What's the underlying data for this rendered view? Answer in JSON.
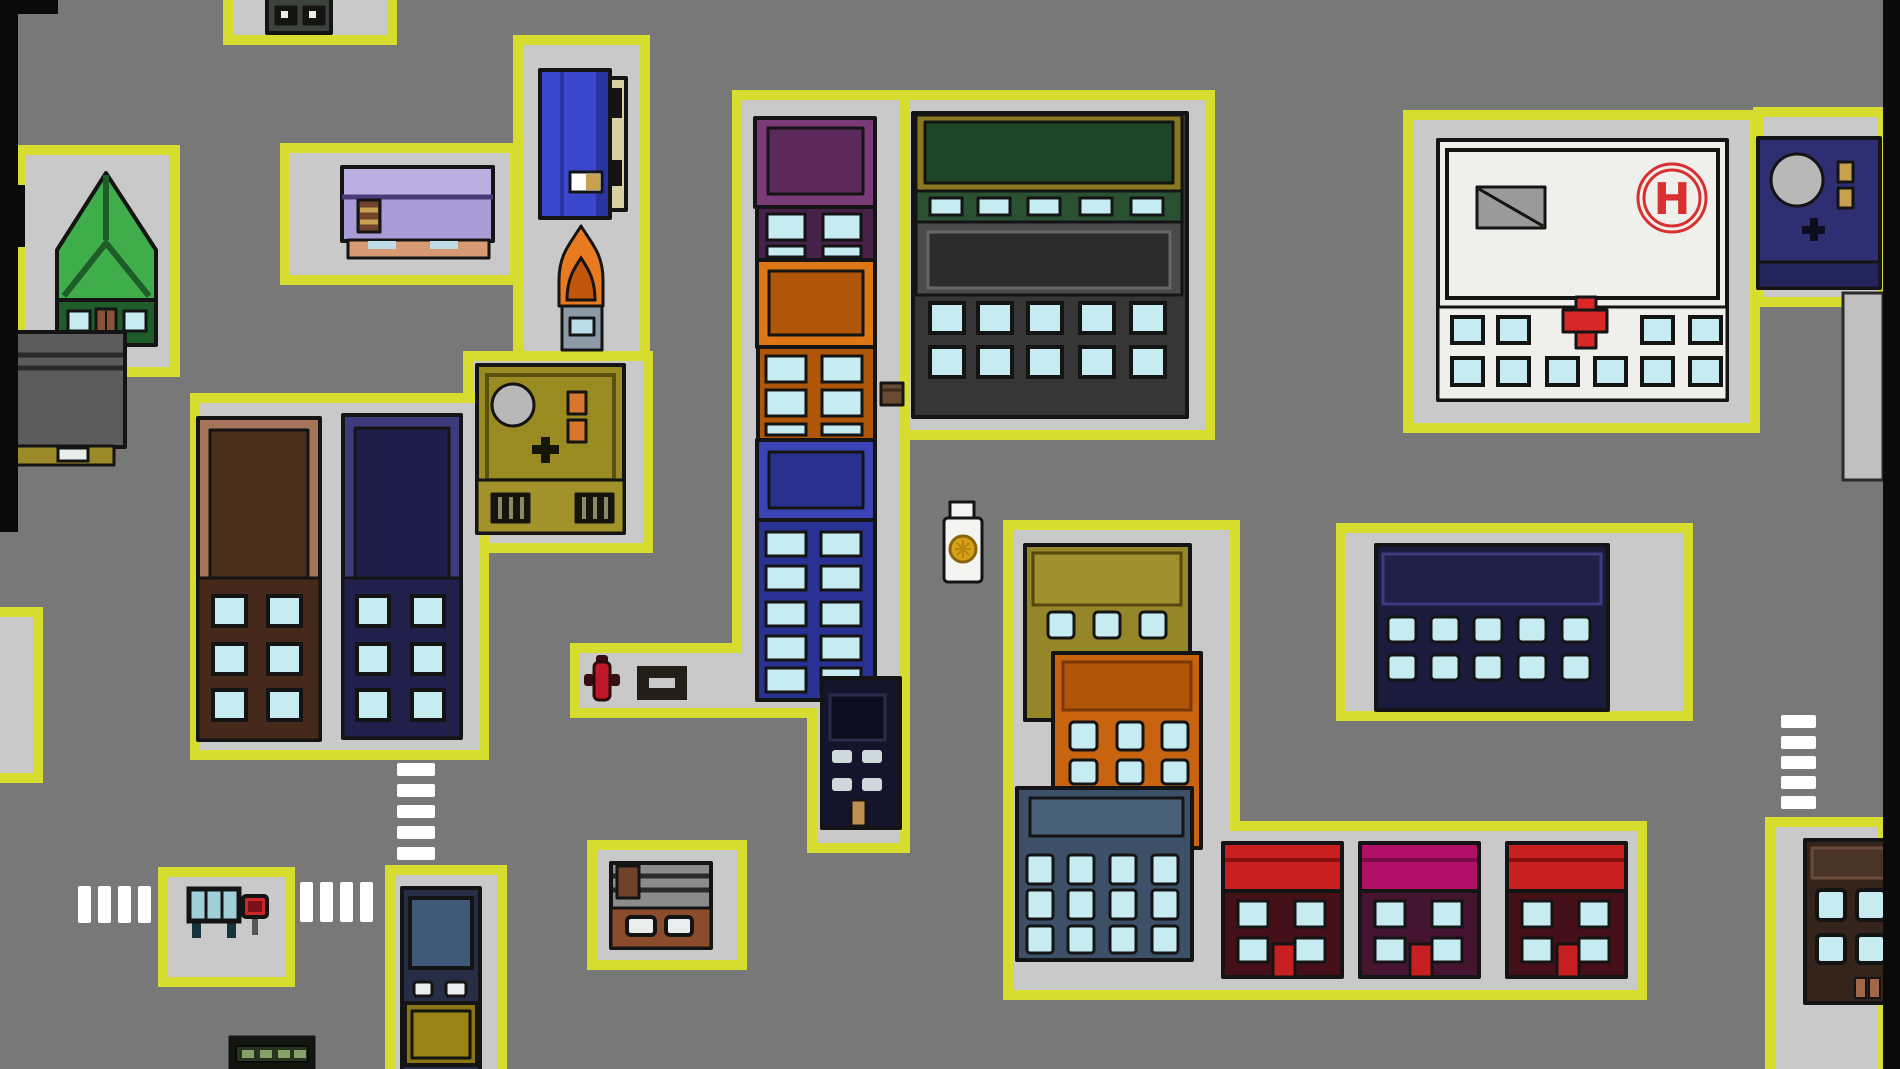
{
  "scene": {
    "name": "top-down-city-map",
    "type": "2d-game-overworld",
    "hospital": {
      "helipad_label": "H"
    },
    "entities": [
      {
        "name": "green-house",
        "kind": "building"
      },
      {
        "name": "rooftop-hvac-small",
        "kind": "rooftop"
      },
      {
        "name": "lavender-store",
        "kind": "building"
      },
      {
        "name": "blue-vending-machine",
        "kind": "building"
      },
      {
        "name": "flame-food-cart",
        "kind": "street-object"
      },
      {
        "name": "olive-military-rooftop",
        "kind": "building"
      },
      {
        "name": "brown-apartment-tower",
        "kind": "building"
      },
      {
        "name": "navy-apartment-tower",
        "kind": "building"
      },
      {
        "name": "stacked-tower-purple-orange-blue",
        "kind": "building"
      },
      {
        "name": "dark-highrise-small",
        "kind": "building"
      },
      {
        "name": "green-gold-office-block",
        "kind": "building"
      },
      {
        "name": "hospital-with-helipad",
        "kind": "building"
      },
      {
        "name": "navy-rooftop-right",
        "kind": "building"
      },
      {
        "name": "navy-office-block",
        "kind": "building"
      },
      {
        "name": "olive-block",
        "kind": "building"
      },
      {
        "name": "orange-apartment",
        "kind": "building"
      },
      {
        "name": "steel-blue-apartment",
        "kind": "building"
      },
      {
        "name": "red-shop-1",
        "kind": "building"
      },
      {
        "name": "magenta-shop",
        "kind": "building"
      },
      {
        "name": "red-shop-2",
        "kind": "building"
      },
      {
        "name": "brown-apartment-bottom-right",
        "kind": "building"
      },
      {
        "name": "brown-kiosk",
        "kind": "building"
      },
      {
        "name": "slate-vending-tower",
        "kind": "building"
      },
      {
        "name": "gray-rooftop-left",
        "kind": "building"
      },
      {
        "name": "bus-stop-shelter",
        "kind": "street-object"
      },
      {
        "name": "bus-stop-sign",
        "kind": "street-object"
      },
      {
        "name": "bench",
        "kind": "street-object"
      },
      {
        "name": "fire-hydrant",
        "kind": "street-object"
      },
      {
        "name": "wooden-crate",
        "kind": "item"
      },
      {
        "name": "pill-bottle",
        "kind": "item"
      },
      {
        "name": "green-vent-box",
        "kind": "street-object"
      },
      {
        "name": "crosswalk",
        "kind": "road-marking",
        "count": 4
      }
    ]
  },
  "palette": {
    "road": "#787878",
    "sidewalk": "#c9c9c9",
    "sidewalkBorder": "#d6dd2f",
    "outline": "#141414",
    "black": "#0a0a0a",
    "stripe": "#ffffff",
    "window": "#c6ecf2",
    "houseRoof": "#3fae4a",
    "houseWall": "#1e5c2a",
    "houseDoor": "#8a5434",
    "lavLight": "#bcafe2",
    "lav": "#a99bd6",
    "lavDark": "#4a3a78",
    "porch": "#d89a72",
    "barrel": "#6e432a",
    "vendBlue": "#3a46cc",
    "vendBlueDark": "#2a34a0",
    "vendPanel": "#d8cfa4",
    "flame": "#e87a20",
    "flameDark": "#c2560a",
    "cart": "#8c9aa6",
    "cartWindow": "#bcdce8",
    "olive": "#9a8a22",
    "oliveDark": "#5a5010",
    "oliveBase": "#a2922a",
    "grayCircle": "#b8b8b8",
    "ventOrange": "#d87830",
    "grate": "#15150a",
    "grateBar": "#8a8a6a",
    "brownFrame": "#a4755a",
    "brownPanel": "#4a2e1e",
    "brownBody": "#45291a",
    "navyFrame": "#3c3c7c",
    "navyPanel": "#1e1e48",
    "navyBody": "#20204a",
    "purpleFrame": "#7a3a78",
    "purplePanel": "#5c2a5a",
    "purpleWin": "#46224a",
    "orangeFrame": "#dd7614",
    "orangePanel": "#b05608",
    "blueFrame": "#3a44b4",
    "bluePanel": "#28308c",
    "blueWin": "#2a3194",
    "phoneBody": "#14142c",
    "phonePanel": "#0d0d20",
    "phoneWin": "#cfd8da",
    "phoneDoor": "#c09050",
    "goldTrim": "#8a7820",
    "deepGreen": "#1c4627",
    "greenBand": "#2a5132",
    "grayPanelFrame": "#4a4a4a",
    "grayPanel": "#2c2c2c",
    "grayBody": "#363636",
    "hospitalWhite": "#efefec",
    "skylight": "#9a9a9a",
    "medRed": "#d83030",
    "crossRed": "#d82828",
    "navyRoof": "#2e2e72",
    "navyRoofBase": "#23235c",
    "tanVent": "#c8a050",
    "kNavy": "#1b1b3e",
    "kNavyPanel": "#1f1f48",
    "kNavyTrim": "#3c3c7c",
    "stackOlive": "#96862a",
    "stackOlivePanel": "#a0902e",
    "stackOrange": "#c86410",
    "stackOrangePanel": "#b05408",
    "steel": "#3d5068",
    "steelPanel": "#4a6078",
    "shopRed": "#c82020",
    "shopRedBody": "#461018",
    "shopMagenta": "#b01068",
    "shopMagentaBody": "#441430",
    "brBrown": "#34241c",
    "brBrownTrim": "#4a3428",
    "brDoor": "#a06848",
    "shelter": "#16323a",
    "shelterGlass": "#9fd0da",
    "signRed": "#c82828",
    "signInner": "#7a1018",
    "machineBody": "#252e44",
    "machinePanel": "#3e5a78",
    "machineGold": "#8a7414",
    "machineGoldIn": "#9a8418",
    "kioskGray": "#8c8c8c",
    "kioskBrown": "#8a4c2c",
    "whiteWin": "#e9edee",
    "leftGray": "#5c5c5c",
    "leftBase": "#9a8a28",
    "ventBoxDark": "#11160e",
    "ventBox": "#27331e",
    "ventDash": "#86a06a",
    "hydrant": "#c01828",
    "hydrantDark": "#380c14",
    "bench": "#241e18",
    "bottle": "#f4f4f2",
    "bottleLabel": "#d8a018",
    "bottleLabelEdge": "#8a6408",
    "crate": "#6a4a32",
    "darkRoof": "#3c423c",
    "darkWin": "#15150f",
    "rightStrip": "#bfbfbf"
  }
}
